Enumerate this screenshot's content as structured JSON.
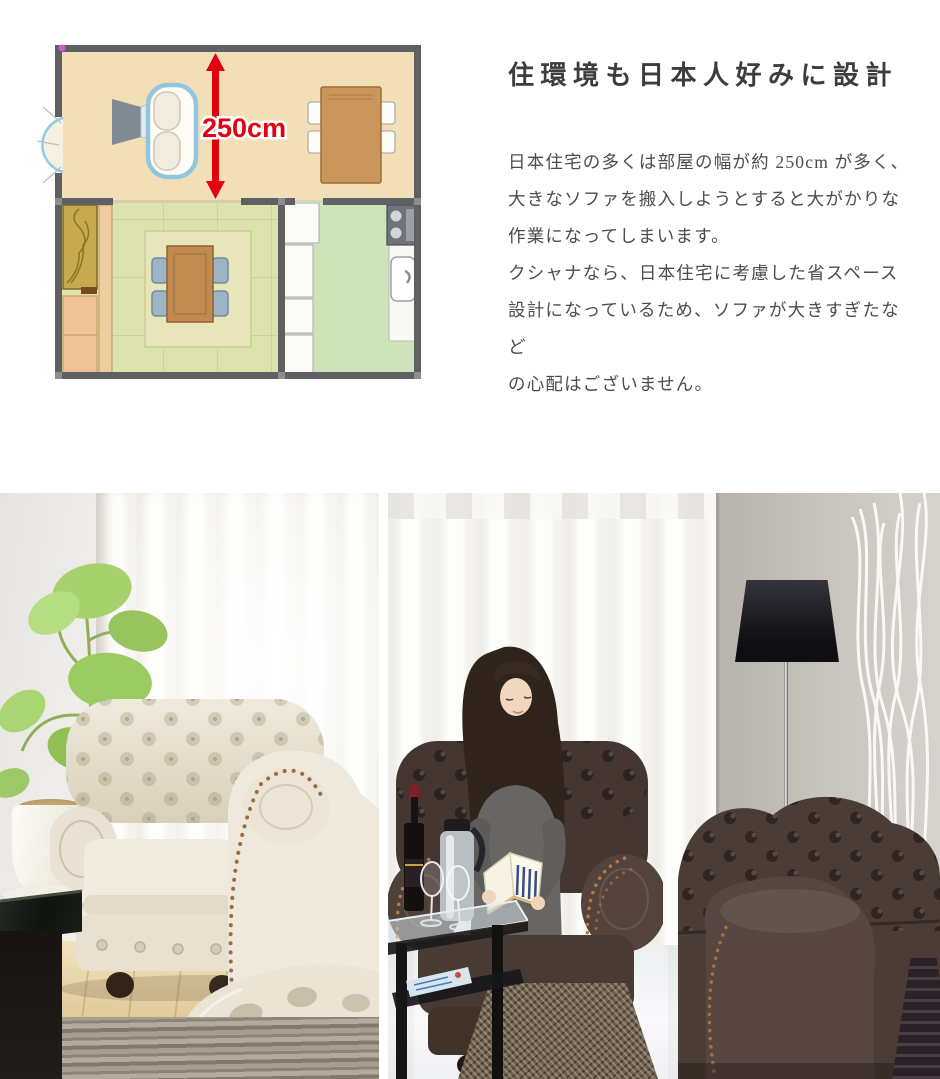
{
  "colors": {
    "accent_red": "#e3000f",
    "heading_text": "#3d3d3d",
    "body_text": "#4d4d4d",
    "plan_wall": "#5f6063",
    "plan_living_floor": "#f2dfb8",
    "plan_tatami_floor": "#dde3ad",
    "plan_kitchen_floor": "#cfe3bb"
  },
  "article": {
    "heading": "住環境も日本人好みに設計",
    "body": "日本住宅の多くは部屋の幅が約 250cm が多く、\n大きなソファを搬入しようとすると大がかりな\n作業になってしまいます。\nクシャナなら、日本住宅に考慮した省スペース\n設計になっているため、ソファが大きすぎたなど\nの心配はございません。"
  },
  "floorplan": {
    "dimension_label": "250cm",
    "rooms": [
      {
        "name": "living-dining"
      },
      {
        "name": "tatami-room"
      },
      {
        "name": "kitchen"
      }
    ]
  },
  "gallery": {
    "left_photo": {
      "description": "Ivory tufted Chesterfield sofa by a bright window with a potted plant and black glass table"
    },
    "right_photo": {
      "description": "Woman reading a book on a dark brown Chesterfield armchair beside a black floor lamp, white branches and a dark brown sofa"
    }
  }
}
